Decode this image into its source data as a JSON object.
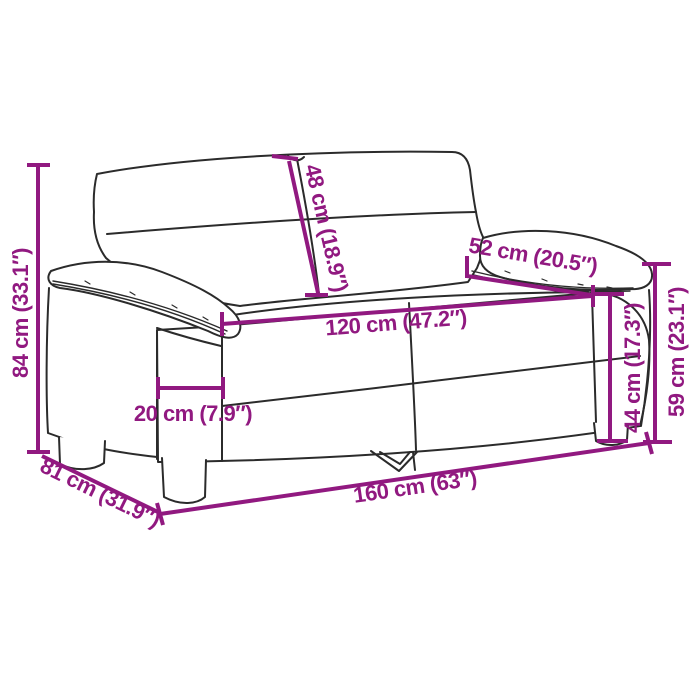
{
  "diagram": {
    "type": "product-dimension-diagram",
    "product": "2-seater sofa line drawing",
    "colors": {
      "dimension_accent": "#911980",
      "outline": "#2b2b2b",
      "background": "#ffffff"
    },
    "dimensions": {
      "total_height": {
        "label": "84 cm (33.1″)"
      },
      "back_cushion_height": {
        "label": "48 cm (18.9″)"
      },
      "armrest_depth": {
        "label": "52 cm (20.5″)"
      },
      "seat_width": {
        "label": "120 cm (47.2″)"
      },
      "armrest_width": {
        "label": "20 cm (7.9″)"
      },
      "seat_height": {
        "label": "44 cm (17.3″)"
      },
      "armrest_height": {
        "label": "59 cm (23.1″)"
      },
      "total_width": {
        "label": "160 cm (63″)"
      },
      "total_depth": {
        "label": "81 cm (31.9″)"
      }
    }
  }
}
